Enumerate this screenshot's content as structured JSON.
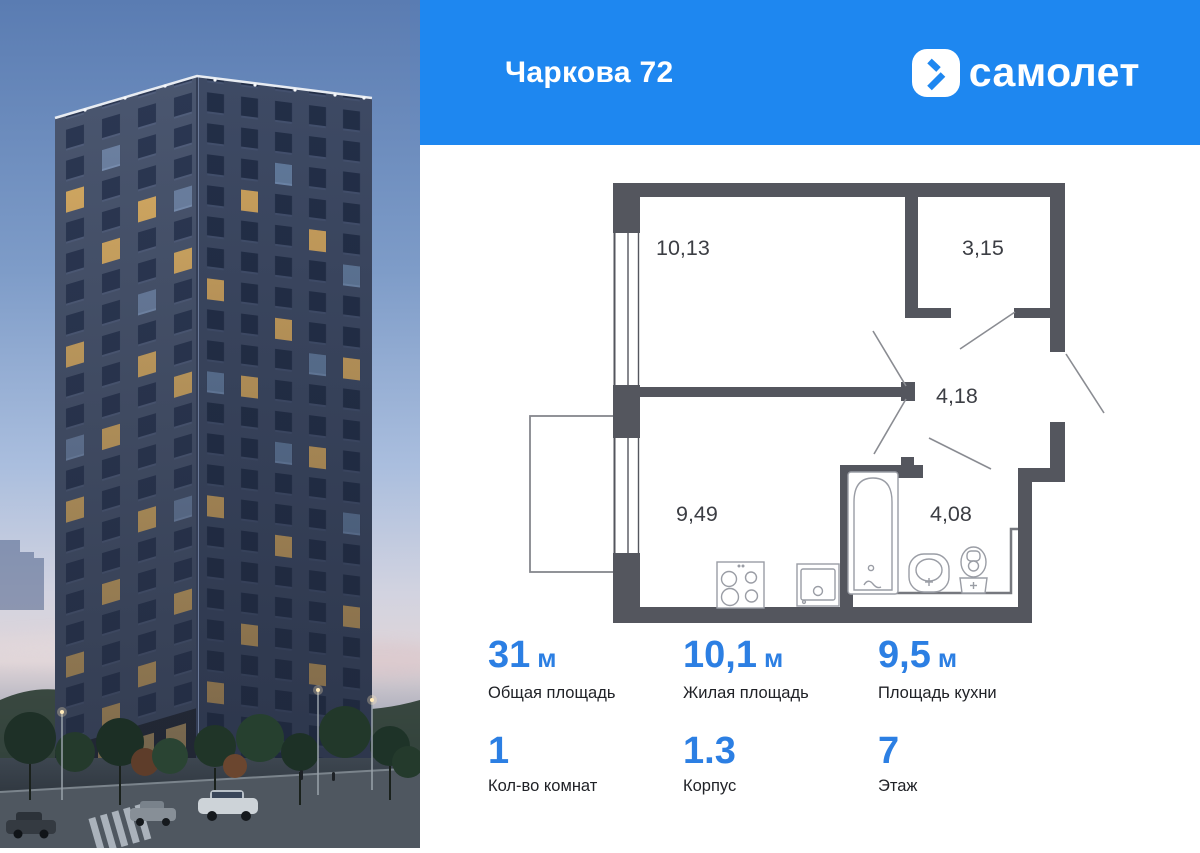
{
  "header": {
    "title": "Чаркова 72",
    "brand": "самолет"
  },
  "floorplan": {
    "rooms": [
      {
        "id": "living",
        "area": "10,13"
      },
      {
        "id": "wardrobe",
        "area": "3,15"
      },
      {
        "id": "hallway",
        "area": "4,18"
      },
      {
        "id": "kitchen",
        "area": "9,49"
      },
      {
        "id": "bathroom",
        "area": "4,08"
      }
    ]
  },
  "stats": {
    "row1": [
      {
        "value": "31",
        "unit": "м",
        "label": "Общая площадь"
      },
      {
        "value": "10,1",
        "unit": "м",
        "label": "Жилая площадь"
      },
      {
        "value": "9,5",
        "unit": "м",
        "label": "Площадь кухни"
      }
    ],
    "row2": [
      {
        "value": "1",
        "label": "Кол-во комнат"
      },
      {
        "value": "1.3",
        "label": "Корпус"
      },
      {
        "value": "7",
        "label": "Этаж"
      }
    ]
  },
  "colors": {
    "header_blue": "#1e87f0",
    "accent_blue": "#2c7fe3",
    "wall_gray": "#54565e"
  }
}
